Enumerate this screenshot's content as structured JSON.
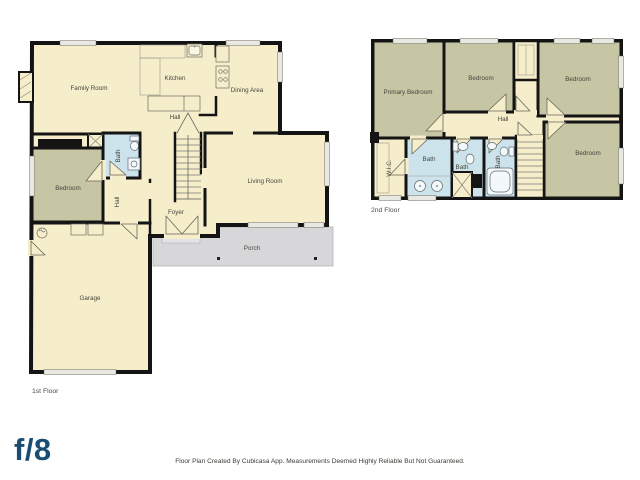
{
  "floor1": {
    "title": "1st Floor",
    "rooms": {
      "family": {
        "label": "Family Room"
      },
      "kitchen": {
        "label": "Kitchen"
      },
      "dining": {
        "label": "Dining Area"
      },
      "hall": {
        "label": "Hall"
      },
      "hall2": {
        "label": "Hall"
      },
      "bath": {
        "label": "Bath"
      },
      "bedroom": {
        "label": "Bedroom"
      },
      "living": {
        "label": "Living Room"
      },
      "foyer": {
        "label": "Foyer"
      },
      "porch": {
        "label": "Porch"
      },
      "garage": {
        "label": "Garage"
      }
    }
  },
  "floor2": {
    "title": "2nd Floor",
    "rooms": {
      "primary": {
        "label": "Primary Bedroom"
      },
      "bedroom_top_middle": {
        "label": "Bedroom"
      },
      "bedroom_top_right": {
        "label": "Bedroom"
      },
      "bedroom_bottom_right": {
        "label": "Bedroom"
      },
      "hall": {
        "label": "Hall"
      },
      "wic": {
        "label": "W.I.C."
      },
      "bath_primary": {
        "label": "Bath"
      },
      "bath_middle": {
        "label": "Bath"
      },
      "bath_right": {
        "label": "Bath"
      }
    }
  },
  "footer": {
    "logo": "f/8",
    "disclaimer": "Floor Plan Created By Cubicasa App. Measurements Deemed Highly Reliable But Not Guaranteed."
  },
  "colors": {
    "floor": "#f6eecb",
    "bedroom": "#c6c6a4",
    "bath": "#cde3ec",
    "porch": "#d7d7da",
    "wall": "#141414",
    "logo": "#1b4d73"
  }
}
